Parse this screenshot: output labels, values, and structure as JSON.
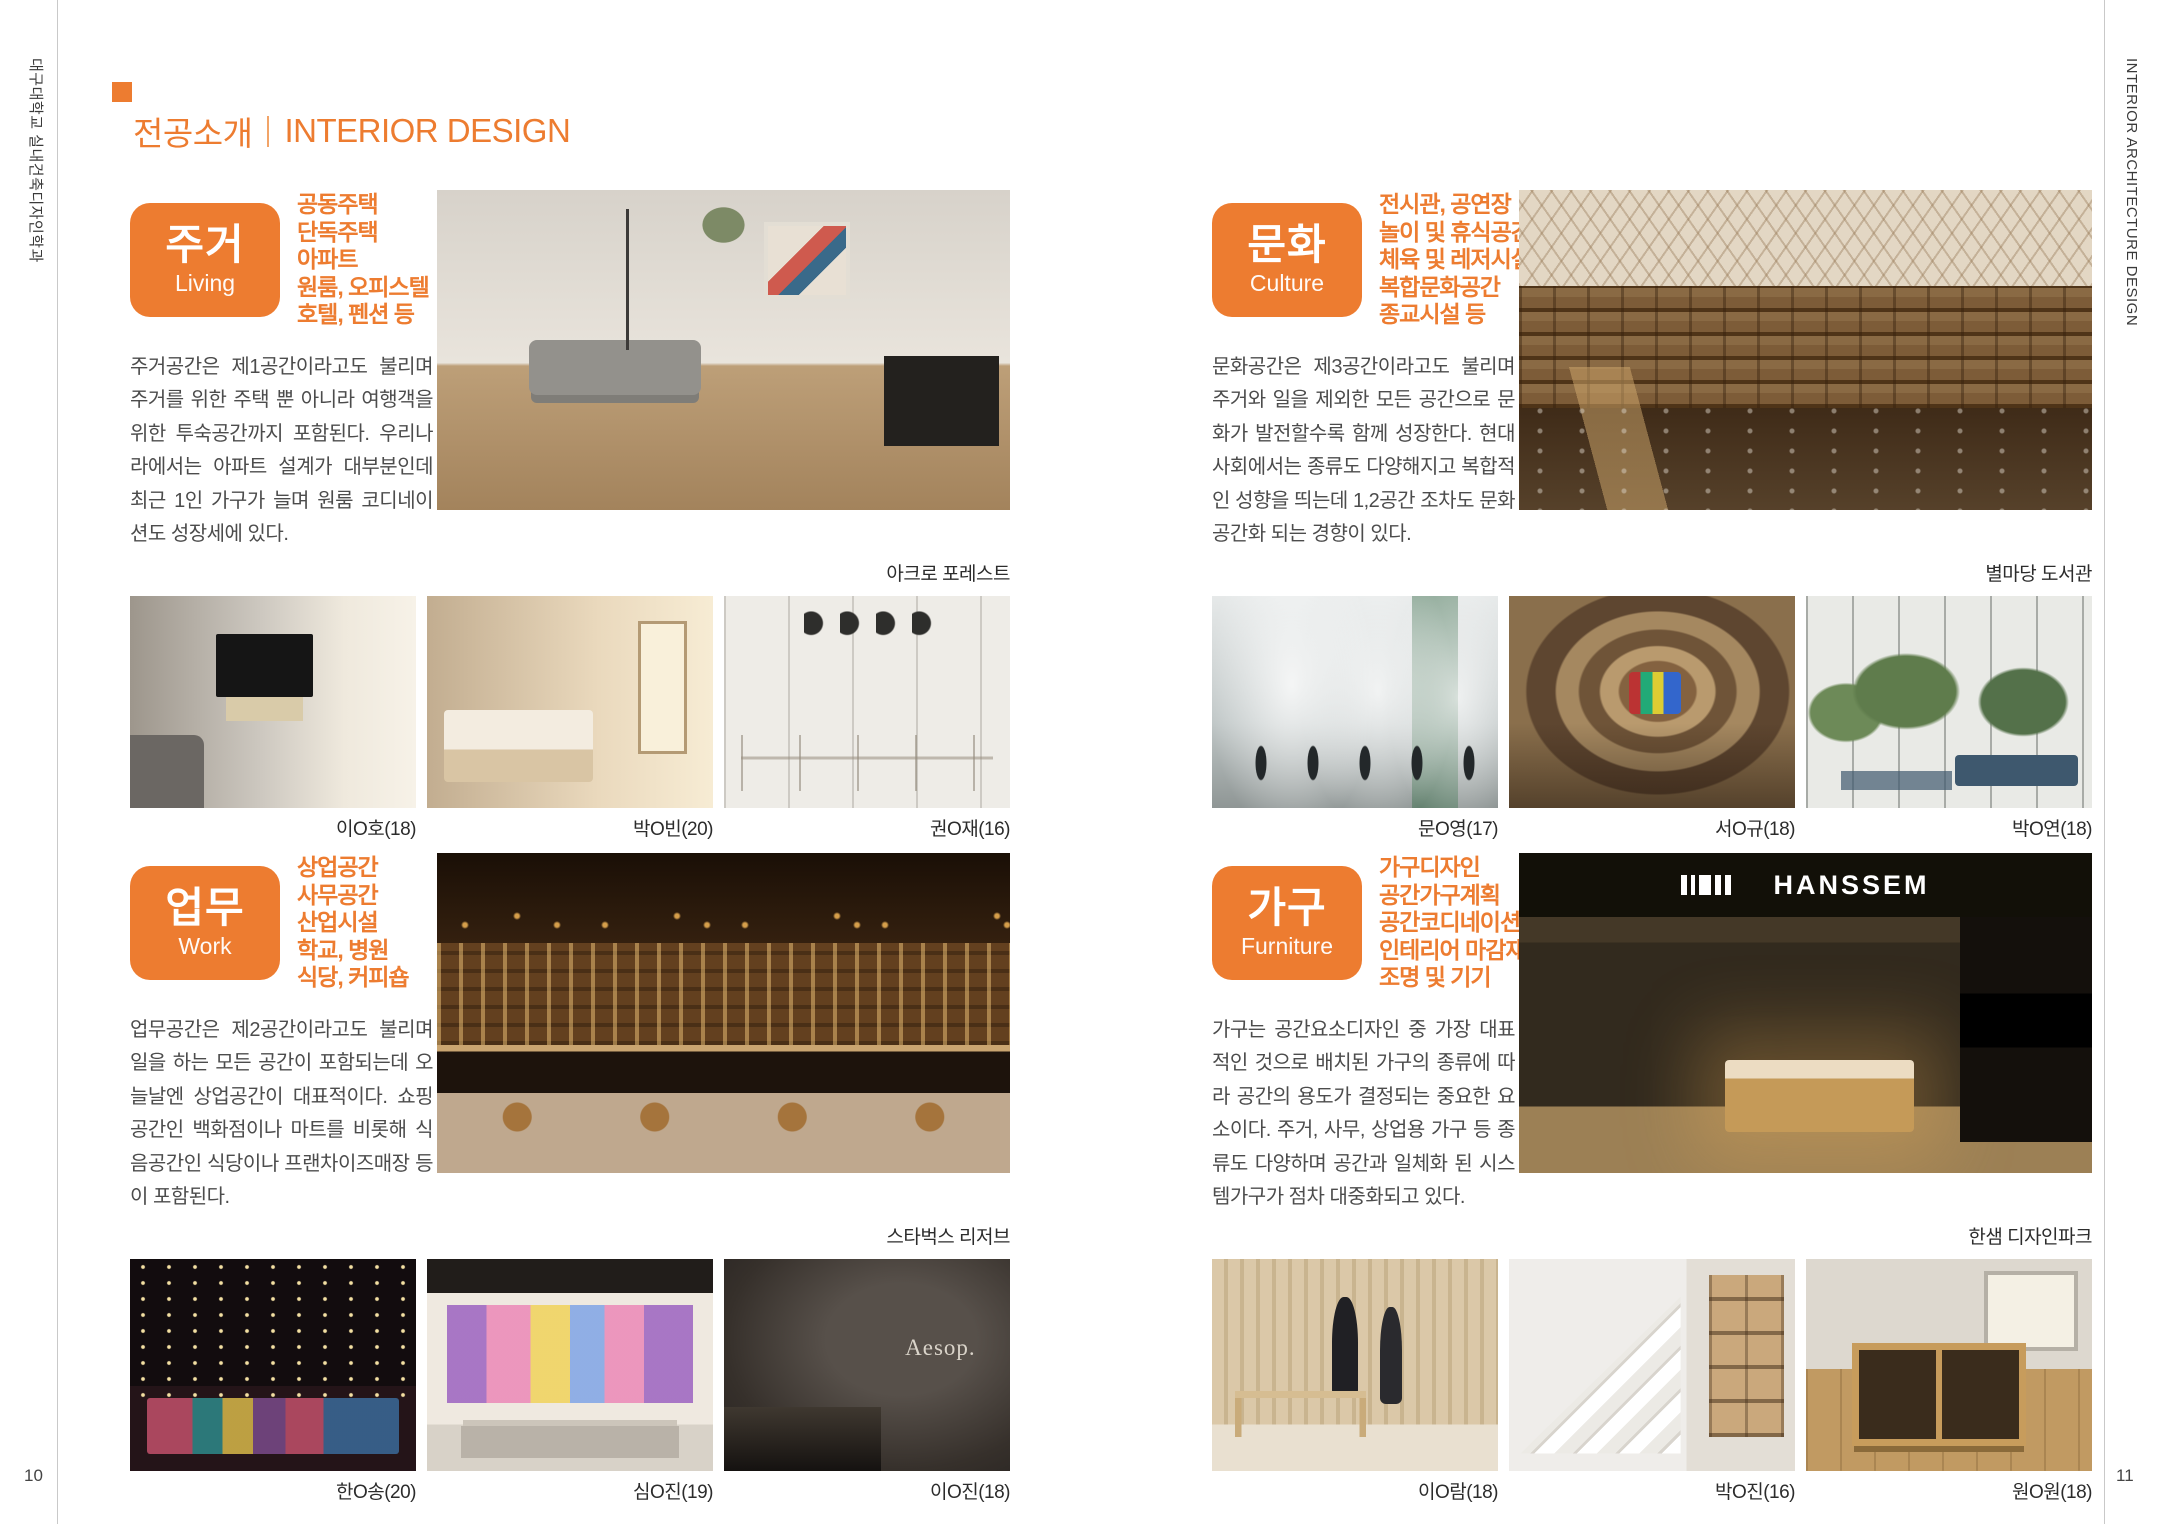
{
  "page": {
    "left_page_number": "10",
    "right_page_number": "11",
    "left_spine": "대구대학교 실내건축디자인학과",
    "right_spine": "INTERIOR ARCHITECTURE DESIGN"
  },
  "header": {
    "title_ko": "전공소개",
    "title_en": "INTERIOR DESIGN"
  },
  "colors": {
    "accent": "#ed7c30"
  },
  "sections": [
    {
      "id": "living",
      "title_ko": "주거",
      "title_en": "Living",
      "keywords": [
        "공동주택",
        "단독주택",
        "아파트",
        "원룸, 오피스텔",
        "호텔, 펜션 등"
      ],
      "description": "주거공간은 제1공간이라고도 불리며 주거를 위한 주택 뿐 아니라 여행객을 위한 투숙공간까지 포함된다. 우리나라에서는 아파트 설계가 대부분인데 최근 1인 가구가 늘며 원룸 코디네이션도 성장세에 있다.",
      "main_image": {
        "caption": "아크로 포레스트"
      },
      "thumbnails": [
        {
          "caption": "이O호(18)"
        },
        {
          "caption": "박O빈(20)"
        },
        {
          "caption": "권O재(16)"
        }
      ]
    },
    {
      "id": "culture",
      "title_ko": "문화",
      "title_en": "Culture",
      "keywords": [
        "전시관, 공연장",
        "놀이 및 휴식공간",
        "체육 및 레저시설",
        "복합문화공간",
        "종교시설 등"
      ],
      "description": "문화공간은 제3공간이라고도 불리며 주거와 일을 제외한 모든 공간으로 문화가 발전할수록 함께 성장한다. 현대사회에서는 종류도 다양해지고 복합적인 성향을 띄는데 1,2공간 조차도 문화공간화 되는 경향이 있다.",
      "main_image": {
        "caption": "별마당 도서관"
      },
      "thumbnails": [
        {
          "caption": "문O영(17)"
        },
        {
          "caption": "서O규(18)"
        },
        {
          "caption": "박O연(18)"
        }
      ]
    },
    {
      "id": "work",
      "title_ko": "업무",
      "title_en": "Work",
      "keywords": [
        "상업공간",
        "사무공간",
        "산업시설",
        "학교, 병원",
        "식당, 커피숍"
      ],
      "description": "업무공간은 제2공간이라고도 불리며 일을 하는 모든 공간이 포함되는데 오늘날엔 상업공간이 대표적이다. 쇼핑공간인 백화점이나 마트를 비롯해 식음공간인 식당이나 프랜차이즈매장 등이 포함된다.",
      "main_image": {
        "caption": "스타벅스 리저브"
      },
      "thumbnails": [
        {
          "caption": "한O송(20)"
        },
        {
          "caption": "심O진(19)"
        },
        {
          "caption": "이O진(18)",
          "overlay": "Aesop."
        }
      ]
    },
    {
      "id": "furniture",
      "title_ko": "가구",
      "title_en": "Furniture",
      "keywords": [
        "가구디자인",
        "공간가구계획",
        "공간코디네이션",
        "인테리어 마감재",
        "조명 및 기기"
      ],
      "description": "가구는 공간요소디자인 중 가장 대표적인 것으로 배치된 가구의 종류에 따라 공간의 용도가 결정되는 중요한 요소이다. 주거, 사무, 상업용 가구 등 종류도 다양하며 공간과 일체화 된 시스템가구가 점차 대중화되고 있다.",
      "main_image": {
        "caption": "한샘 디자인파크",
        "overlay": "HANSSEM"
      },
      "thumbnails": [
        {
          "caption": "이O람(18)"
        },
        {
          "caption": "박O진(16)"
        },
        {
          "caption": "원O원(18)"
        }
      ]
    }
  ]
}
